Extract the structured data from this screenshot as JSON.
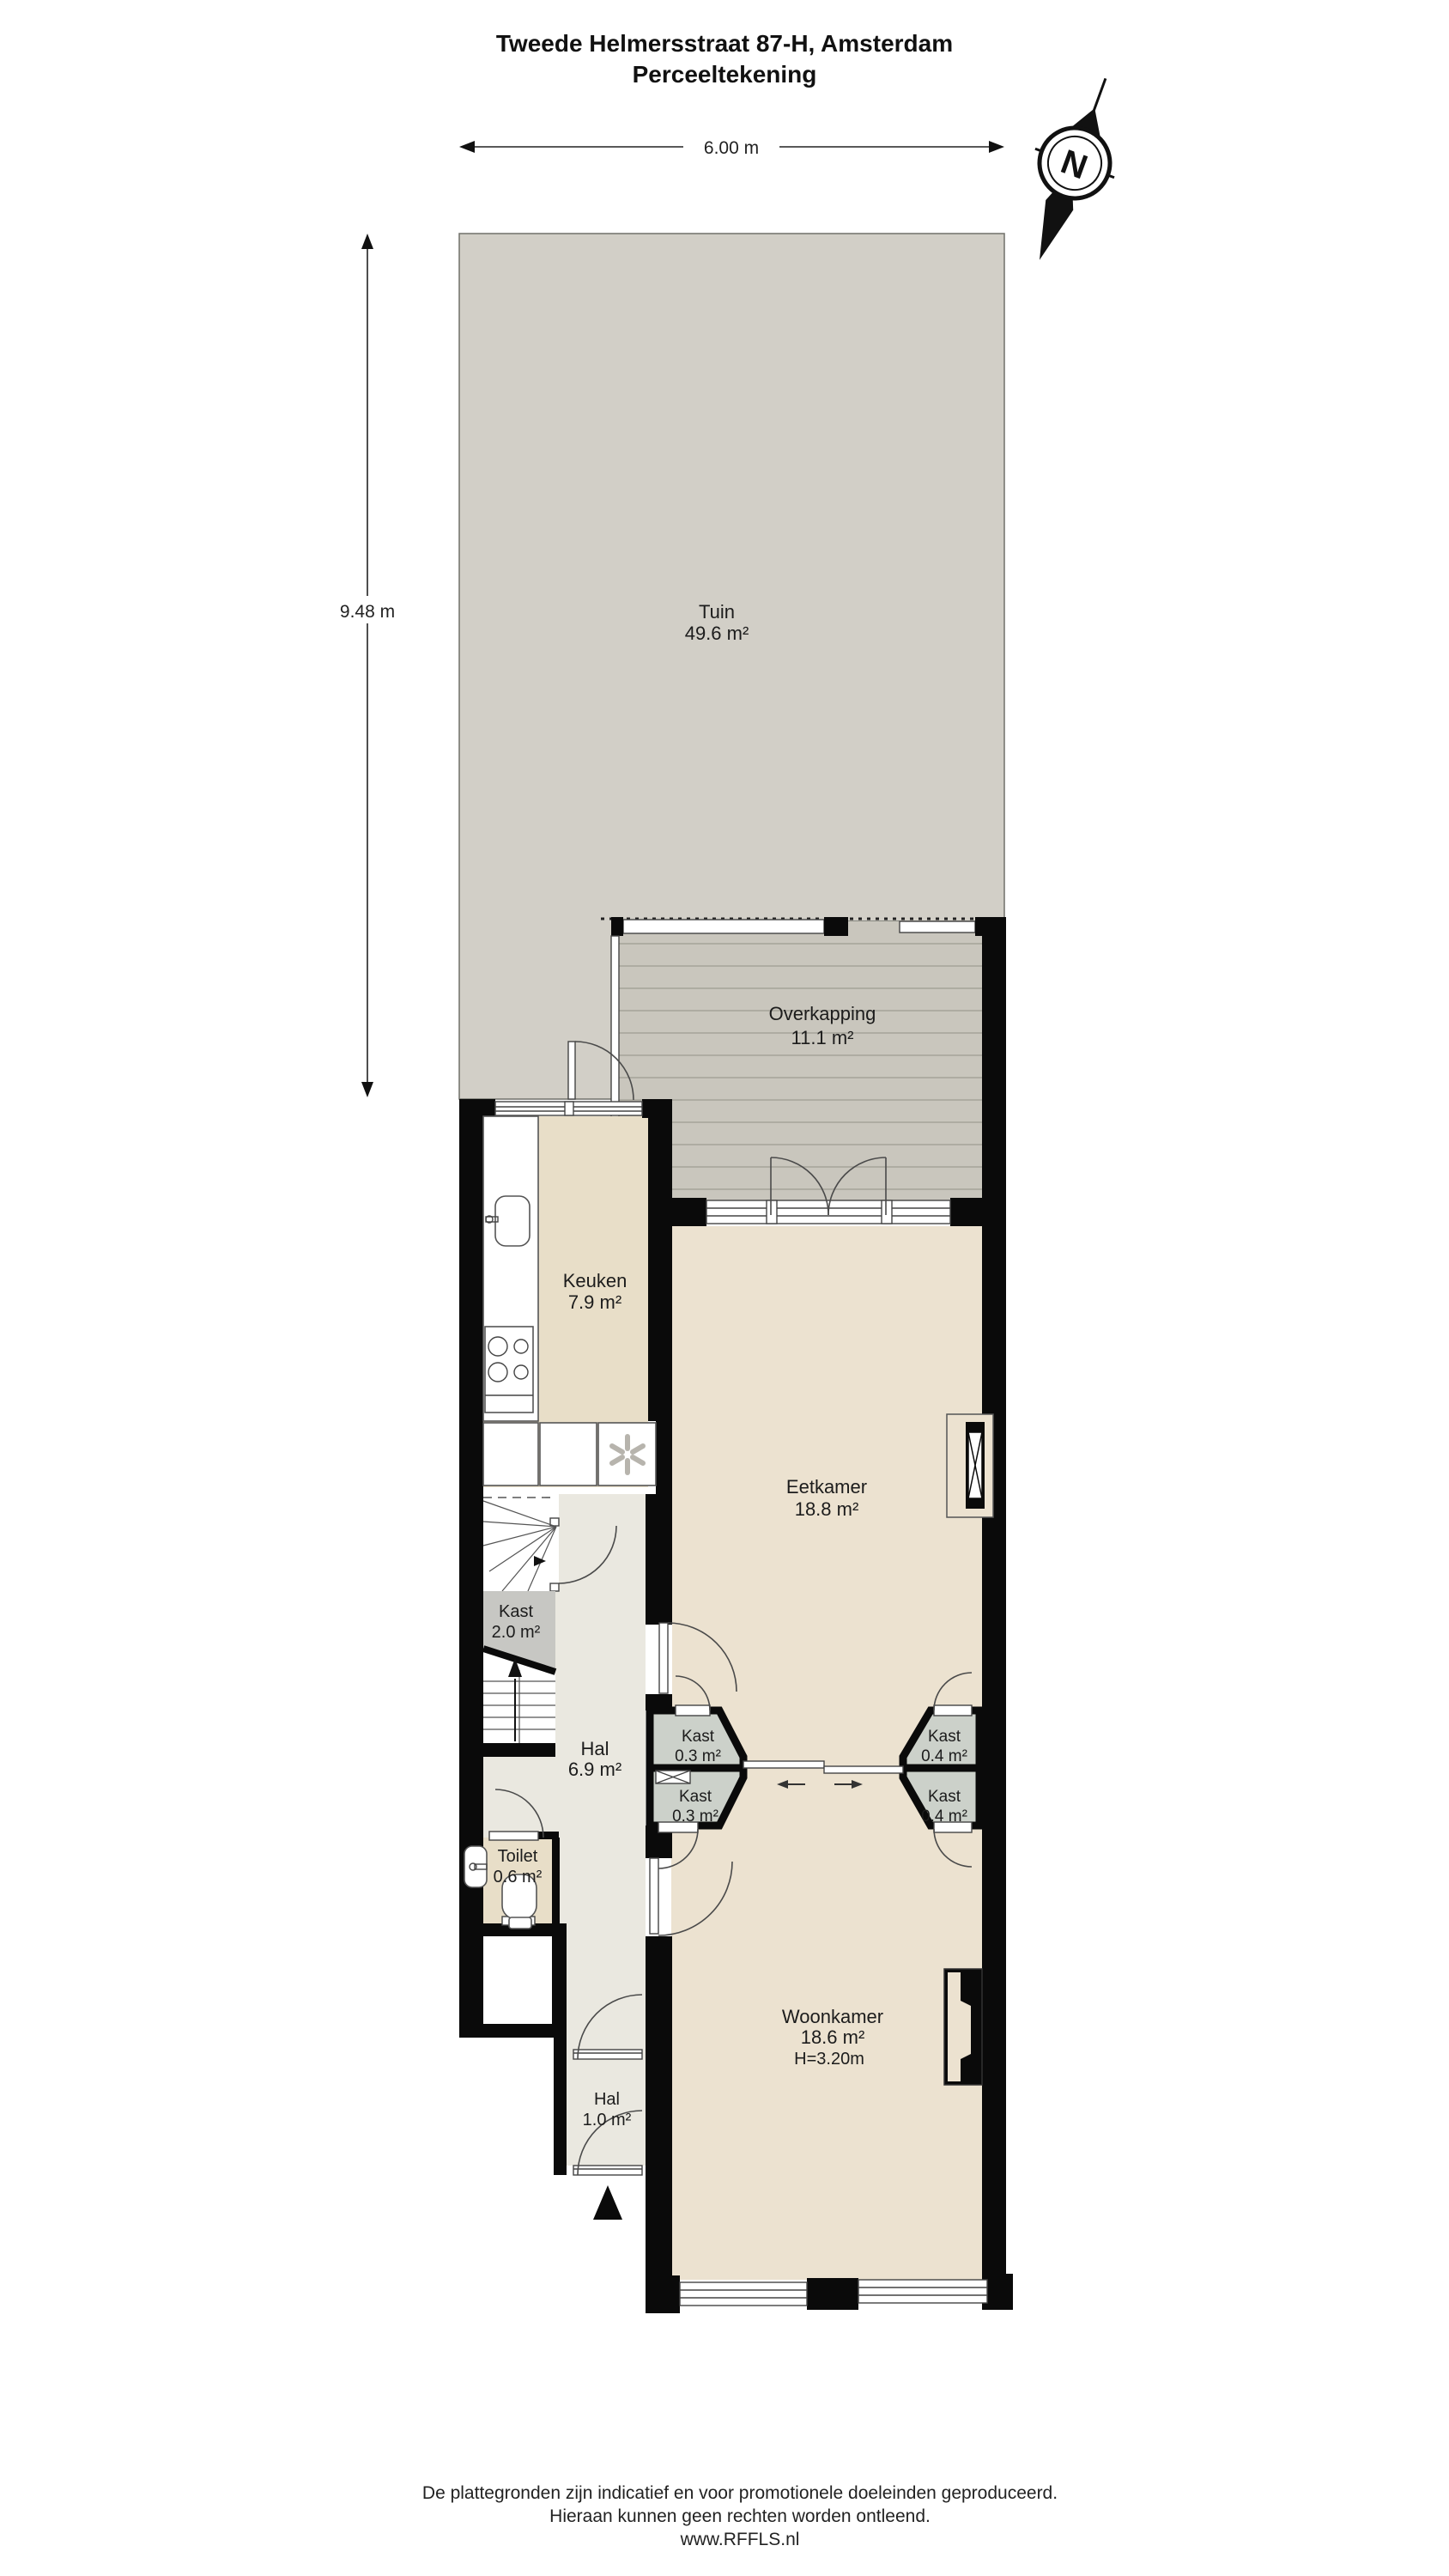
{
  "title": {
    "line1": "Tweede Helmersstraat 87-H, Amsterdam",
    "line2": "Perceeltekening"
  },
  "dimensions": {
    "plot_width": "6.00 m",
    "plot_depth": "9.48 m"
  },
  "compass": {
    "north_label": "N"
  },
  "rooms": {
    "tuin": {
      "name": "Tuin",
      "area": "49.6 m²"
    },
    "overkapping": {
      "name": "Overkapping",
      "area": "11.1 m²"
    },
    "keuken": {
      "name": "Keuken",
      "area": "7.9 m²"
    },
    "eetkamer": {
      "name": "Eetkamer",
      "area": "18.8 m²"
    },
    "kast_trap": {
      "name": "Kast",
      "area": "2.0 m²"
    },
    "hal": {
      "name": "Hal",
      "area": "6.9 m²"
    },
    "kast_links_boven": {
      "name": "Kast",
      "area": "0.3 m²"
    },
    "kast_links_onder": {
      "name": "Kast",
      "area": "0.3 m²"
    },
    "kast_rechts_boven": {
      "name": "Kast",
      "area": "0.4 m²"
    },
    "kast_rechts_onder": {
      "name": "Kast",
      "area": "0.4 m²"
    },
    "toilet": {
      "name": "Toilet",
      "area": "0.6 m²"
    },
    "woonkamer": {
      "name": "Woonkamer",
      "area": "18.6 m²",
      "ceiling_height": "H=3.20m"
    },
    "hal_entree": {
      "name": "Hal",
      "area": "1.0 m²"
    }
  },
  "footer": {
    "line1": "De plattegronden zijn indicatief en voor promotionele doeleinden geproduceerd.",
    "line2": "Hieraan kunnen geen rechten worden ontleend.",
    "line3": "www.RFFLS.nl"
  },
  "colors": {
    "wall": "#0a0a0a",
    "garden": "#d2cfc7",
    "deck": "#c9c6bd",
    "deck_plank": "#a6a39a",
    "floor_kitchen": "#e8dec8",
    "floor_living": "#ece2d0",
    "floor_hall": "#eae8e0",
    "closet_fill": "#ccd1ca",
    "understair_fill": "#c7c7c3"
  }
}
